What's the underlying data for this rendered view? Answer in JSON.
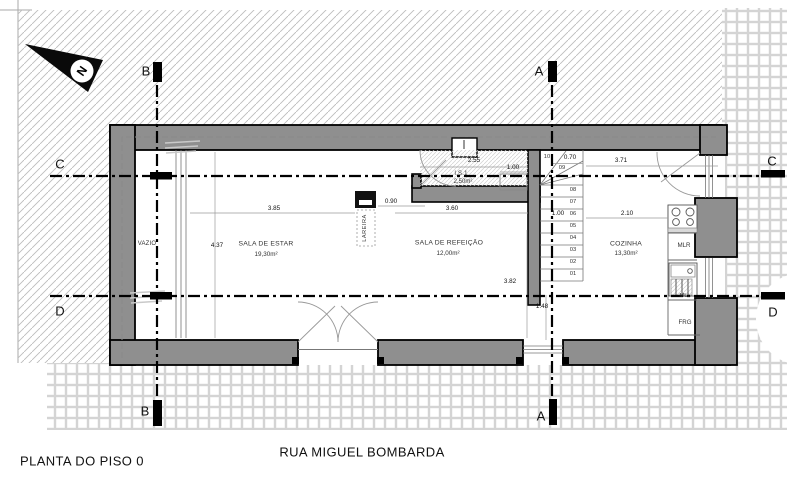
{
  "title": "PLANTA DO PISO 0",
  "street": "RUA MIGUEL BOMBARDA",
  "north": {
    "label": "N"
  },
  "sections": {
    "a": "A",
    "b": "B",
    "c": "C",
    "d": "D"
  },
  "rooms": {
    "vazio": {
      "name": "VAZIO"
    },
    "sala_de_estar": {
      "name": "SALA DE ESTAR",
      "area": "19,30m²"
    },
    "sala_de_refeicao": {
      "name": "SALA DE REFEIÇÃO",
      "area": "12,00m²"
    },
    "cozinha": {
      "name": "COZINHA",
      "area": "13,30m²"
    },
    "is1": {
      "name": "I.S.1",
      "area": "2,50m²"
    },
    "lareira": {
      "name": "LAREIRA"
    }
  },
  "appliances": {
    "mlr": "MLR",
    "mll": "MLL",
    "frg": "FRG"
  },
  "stairs": {
    "steps": [
      "10",
      "09",
      "08",
      "07",
      "06",
      "05",
      "04",
      "03",
      "02",
      "01"
    ],
    "dim_top": "0.70",
    "dim_mid": "1.00"
  },
  "dimensions": {
    "estar_width": "3.85",
    "estar_depth": "4.37",
    "lareira_offset": "0.90",
    "refeicao_width": "3.60",
    "is1_width": "2.55",
    "is1_fixture": "1.00",
    "refeicao_depth": "3.82",
    "window_offset": "1.48",
    "cozinha_width": "2.10",
    "cozinha_total": "3.71"
  }
}
